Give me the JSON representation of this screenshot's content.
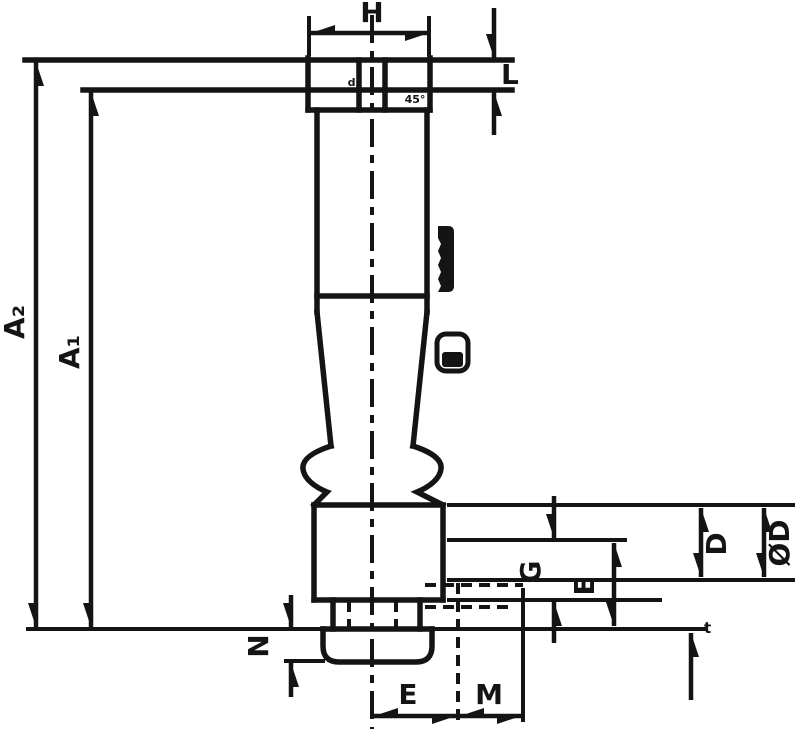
{
  "page": {
    "background": "#ffffff",
    "ink": "#141414"
  },
  "drawing": {
    "kind": "technical-dimension-drawing",
    "dimensions": {
      "H": "H",
      "L": "L",
      "A2": "A₂",
      "A1": "A₁",
      "N": "N",
      "E_bottom": "E",
      "M": "M",
      "G": "G",
      "E_side": "E",
      "D": "D",
      "OD": "ØD",
      "t": "t",
      "d2": "d₂",
      "chamfer": "45°"
    }
  }
}
